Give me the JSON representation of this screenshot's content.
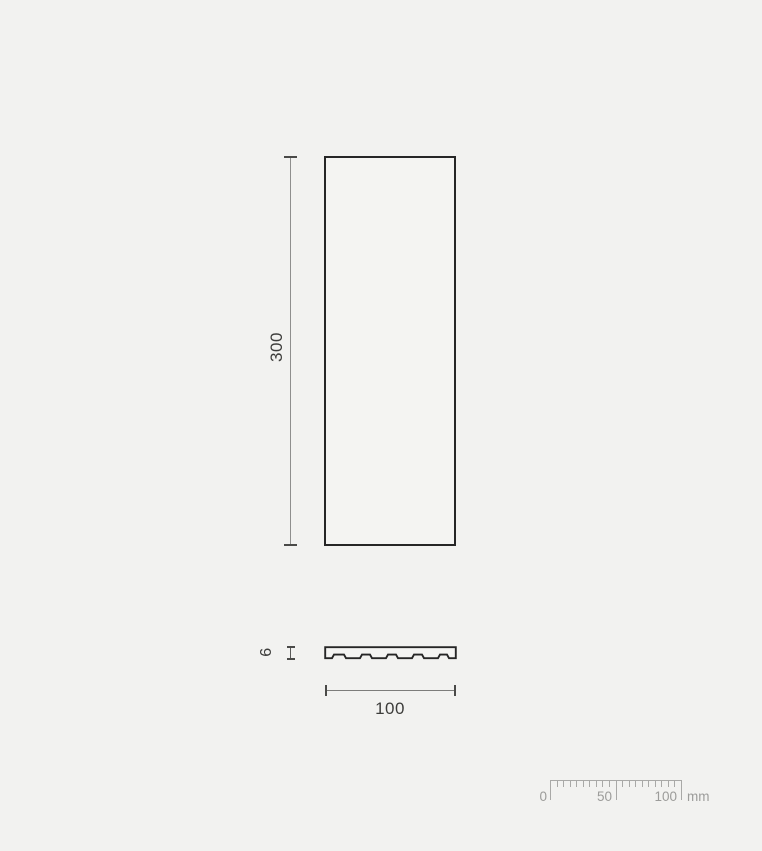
{
  "drawing": {
    "type": "technical-dimension-drawing",
    "views": {
      "front": {
        "height_label": "300",
        "width_label": "100"
      },
      "section": {
        "thickness_label": "6"
      }
    },
    "colors": {
      "background": "#f2f2f0",
      "outline": "#262626",
      "dim_line": "#8f8f8d",
      "dim_text": "#3d3d3b",
      "ruler": "#a9a9a7",
      "ruler_text": "#9c9c9a"
    }
  },
  "ruler": {
    "label_0": "0",
    "label_50": "50",
    "label_100": "100",
    "unit": "mm",
    "range_mm": 100,
    "minor_step_mm": 5,
    "major_step_mm": 50,
    "px_per_mm": 1.31
  }
}
